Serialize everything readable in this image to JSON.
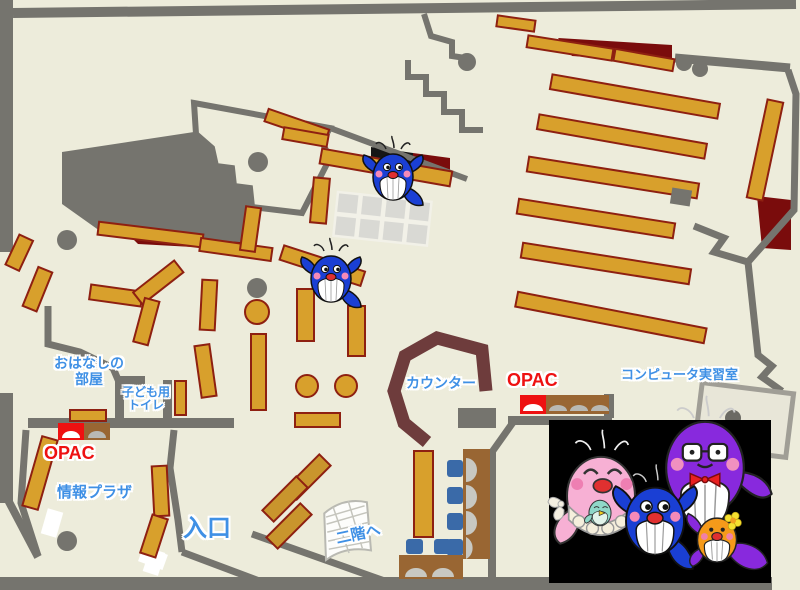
{
  "map": {
    "rooms": {
      "storytelling_room": {
        "label_line1": "おはなしの",
        "label_line2": "部屋"
      },
      "kids_toilet": {
        "label_line1": "子ども用",
        "label_line2": "トイレ"
      },
      "info_plaza": {
        "label": "情報プラザ"
      },
      "entrance": {
        "label": "入口"
      },
      "counter": {
        "label": "カウンター"
      },
      "stairs_to_2f": {
        "label": "二階へ"
      },
      "computer_room": {
        "label": "コンピュータ実習室"
      }
    },
    "terminals": {
      "opac_left": {
        "label": "OPAC"
      },
      "opac_right": {
        "label": "OPAC"
      }
    },
    "colors": {
      "floor": "#edecdb",
      "wall_gray": "#75746e",
      "shelf_gold": "#d8a02c",
      "shelf_dark_gold": "#c9952d",
      "shelf_border": "#8e2011",
      "counter_maroon": "#6e3c3c",
      "accent_dark_red": "#7a0c0c",
      "label_blue": "#3f90e5",
      "label_red": "#ee1111",
      "chair_blue": "#3a6aa8",
      "desk_brown": "#996633",
      "photo_background": "#000000"
    },
    "mascots": {
      "map_whale_count": 2,
      "photo_characters": [
        "pink-whale-mother",
        "teal-baby-whale",
        "purple-whale-father",
        "blue-whale-child",
        "orange-whale-child"
      ]
    }
  }
}
